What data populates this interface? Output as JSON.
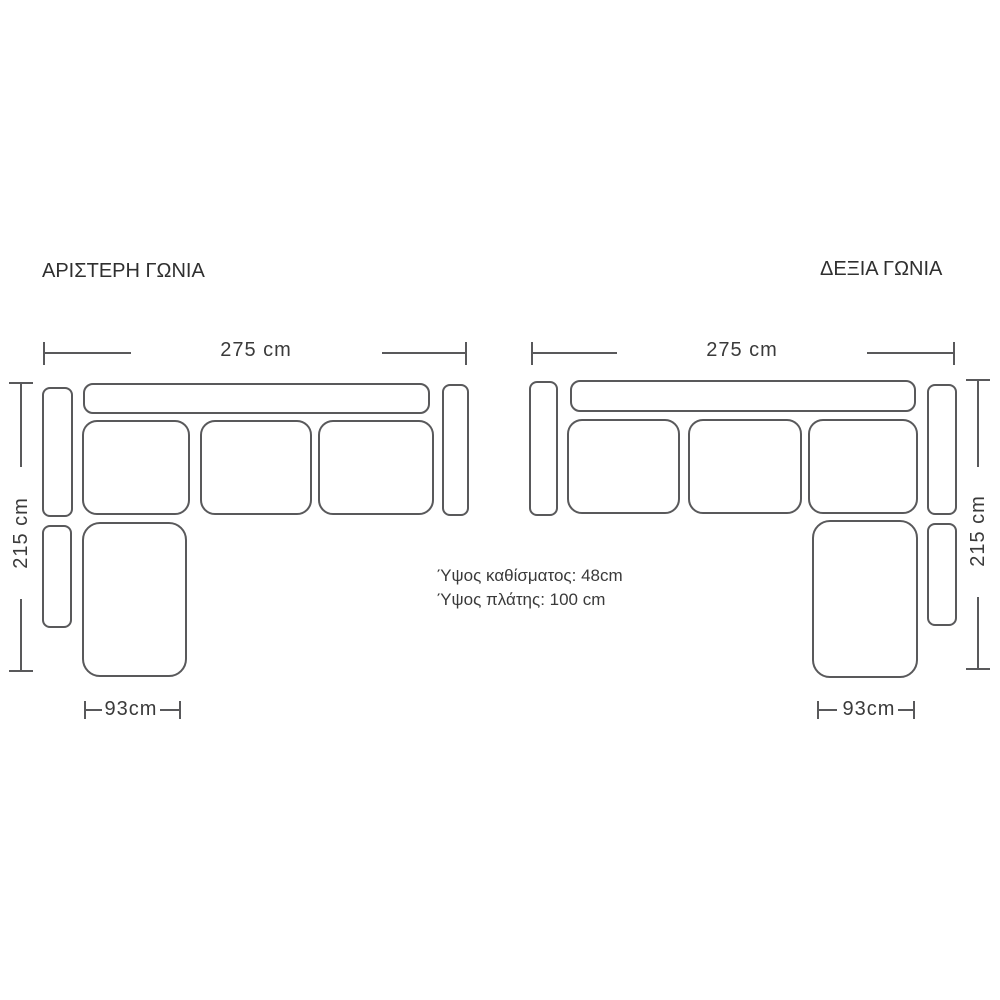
{
  "left_diagram": {
    "title": "ΑΡΙΣΤΕΡΗ ΓΩΝΙΑ",
    "width_label": "275 cm",
    "depth_label": "215 cm",
    "chaise_width_label": "93cm"
  },
  "right_diagram": {
    "title": "ΔΕΞΙΑ ΓΩΝΙΑ",
    "width_label": "275 cm",
    "depth_label": "215 cm",
    "chaise_width_label": "93cm"
  },
  "annotations": {
    "seat_height": "Ύψος καθίσματος: 48cm",
    "back_height": "Ύψος πλάτης: 100 cm"
  },
  "colors": {
    "line": "#59595b",
    "text": "#3a3a3a",
    "title_text": "#2f2f2f",
    "background": "#ffffff"
  }
}
